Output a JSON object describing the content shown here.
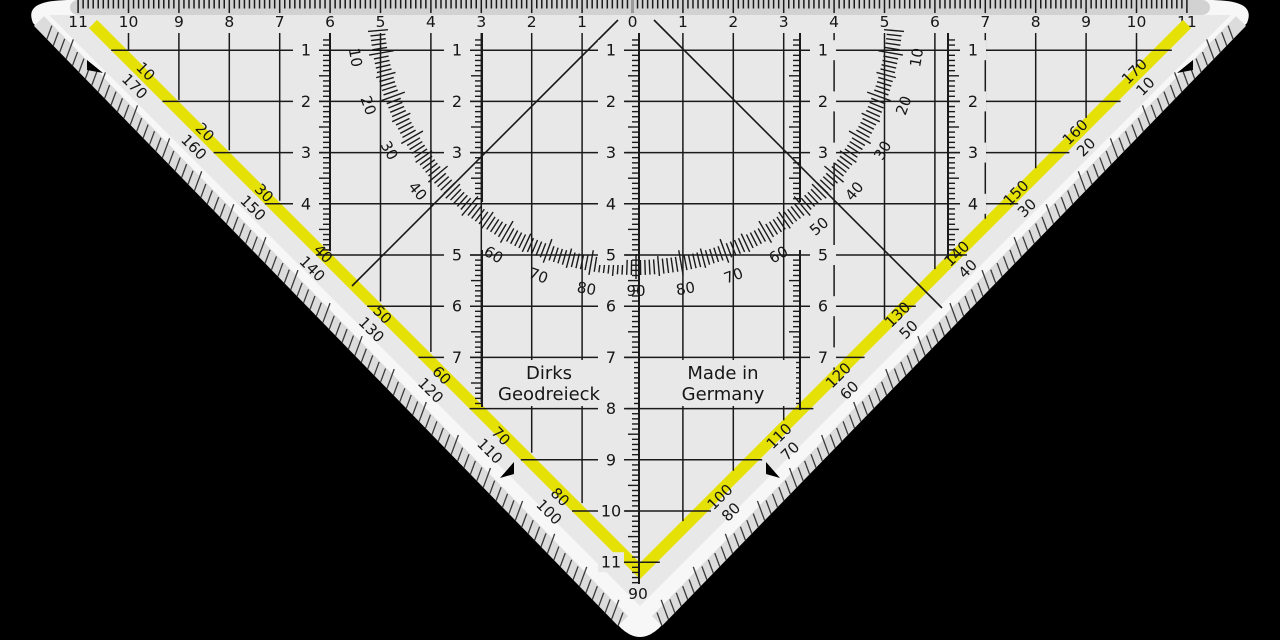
{
  "colors": {
    "background": "#000000",
    "body": "#e8e8e8",
    "strip": "#d2d2d2",
    "bevel": "#f7f7f7",
    "bevel_band": "#dcdcdc",
    "stripe_yellow": "#e6e104",
    "ink": "#1a1a1a",
    "zero_marker": "#9a9a9a",
    "hatch": "#3a3a3a"
  },
  "top_ruler": {
    "numbers": [
      "11",
      "10",
      "9",
      "8",
      "7",
      "6",
      "5",
      "4",
      "3",
      "2",
      "1",
      "0",
      "1",
      "2",
      "3",
      "4",
      "5",
      "6",
      "7",
      "8",
      "9",
      "10",
      "11"
    ]
  },
  "grid": {
    "row_numbers": [
      "1",
      "2",
      "3",
      "4",
      "5",
      "6",
      "7",
      "8",
      "9",
      "10",
      "11"
    ],
    "row_label_columns": [
      {
        "rows": [
          1,
          2,
          3,
          4
        ]
      },
      {
        "rows": [
          1,
          2,
          3,
          5,
          6,
          7
        ]
      },
      {
        "rows": [
          1,
          2,
          3,
          4,
          5,
          6,
          7,
          8,
          9,
          10,
          11
        ]
      },
      {
        "rows": [
          1,
          2,
          3,
          5,
          6,
          7
        ]
      },
      {
        "rows": [
          1,
          2,
          3,
          4
        ]
      }
    ]
  },
  "protractor": {
    "left_degree_labels": [
      "10",
      "20",
      "30",
      "40",
      "60",
      "70",
      "80"
    ],
    "center_degree_label": "90",
    "right_degree_labels": [
      "10",
      "20",
      "30",
      "40",
      "50",
      "60",
      "70",
      "80"
    ]
  },
  "hypotenuse": {
    "left_pairs": [
      [
        "10",
        "170"
      ],
      [
        "20",
        "160"
      ],
      [
        "30",
        "150"
      ],
      [
        "40",
        "140"
      ],
      [
        "50",
        "130"
      ],
      [
        "60",
        "120"
      ],
      [
        "70",
        "110"
      ],
      [
        "80",
        "100"
      ]
    ],
    "right_pairs": [
      [
        "170",
        "10"
      ],
      [
        "160",
        "20"
      ],
      [
        "150",
        "30"
      ],
      [
        "140",
        "40"
      ],
      [
        "130",
        "50"
      ],
      [
        "120",
        "60"
      ],
      [
        "110",
        "70"
      ],
      [
        "100",
        "80"
      ]
    ],
    "apex_degree_label": "90"
  },
  "labels": {
    "brand_line1": "Dirks",
    "brand_line2": "Geodreieck",
    "origin_line1": "Made in",
    "origin_line2": "Germany"
  }
}
